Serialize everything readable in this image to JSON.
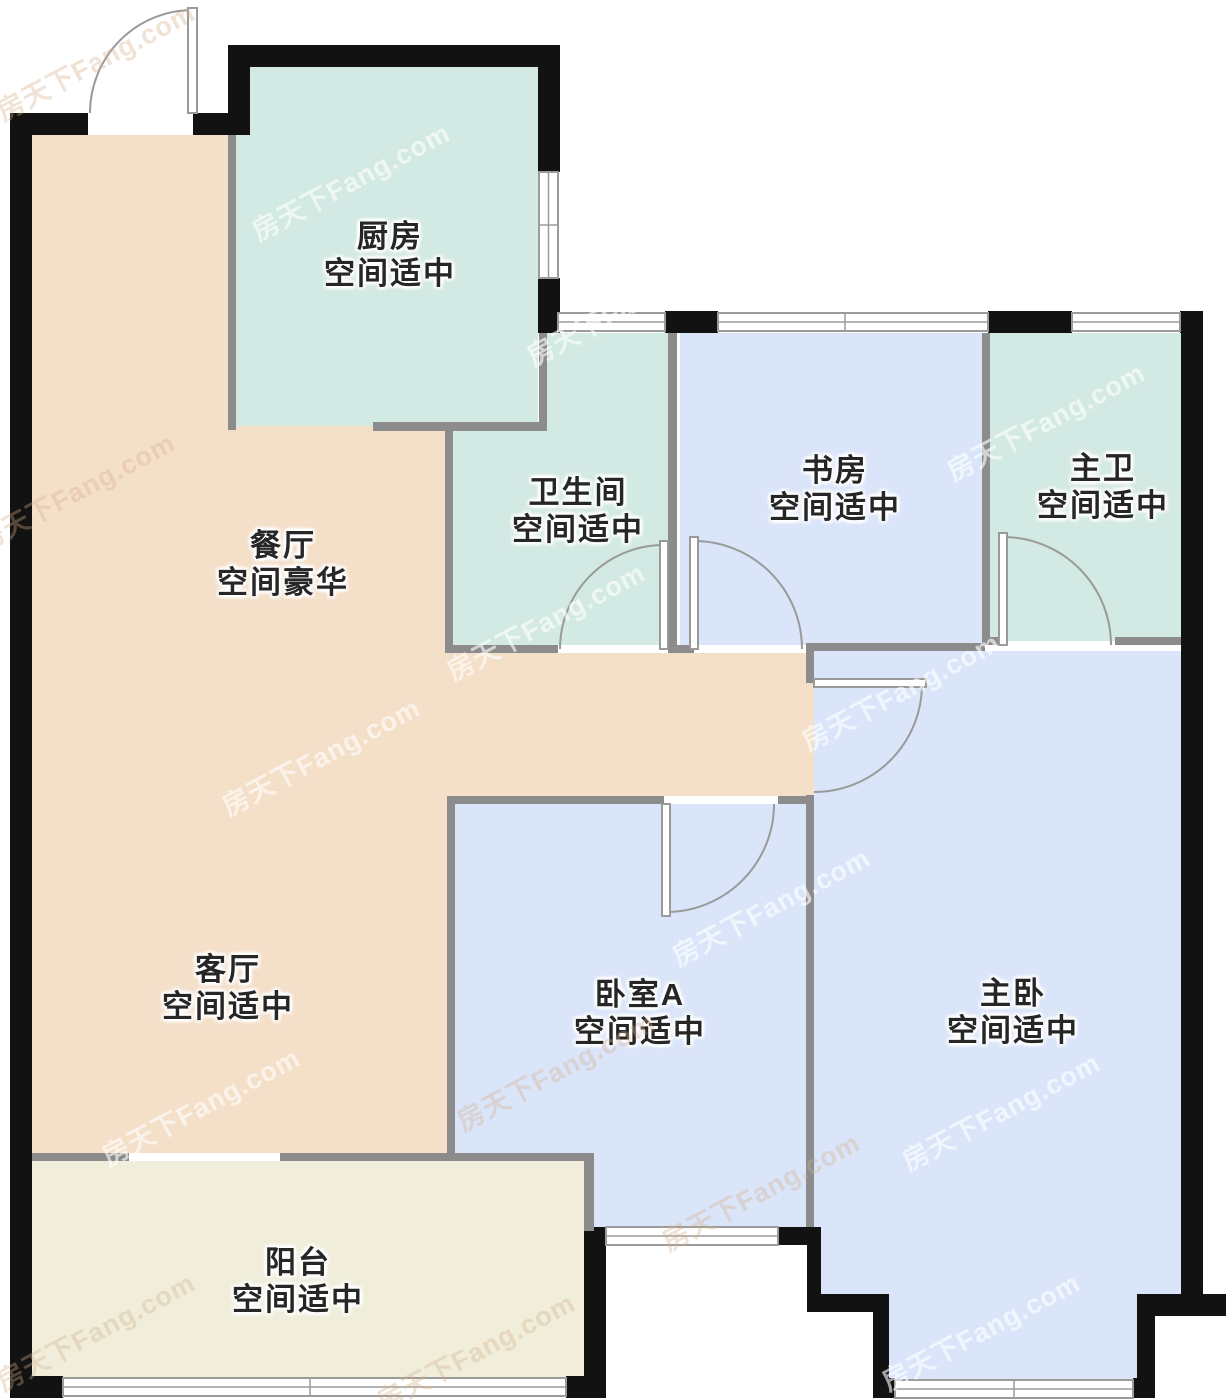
{
  "watermark": "房天下Fang.com",
  "colors": {
    "wall_black": "#121212",
    "wall_gray": "#8c8c8c",
    "room_peach": "#f4dfc9",
    "room_teal": "#d3e9e3",
    "room_blue": "#dae5f9",
    "room_cream": "#f0eeda"
  },
  "rooms": [
    {
      "id": "kitchen",
      "name": "厨房",
      "size_note": "空间适中"
    },
    {
      "id": "bathroom",
      "name": "卫生间",
      "size_note": "空间适中"
    },
    {
      "id": "study",
      "name": "书房",
      "size_note": "空间适中"
    },
    {
      "id": "master-bath",
      "name": "主卫",
      "size_note": "空间适中"
    },
    {
      "id": "dining",
      "name": "餐厅",
      "size_note": "空间豪华"
    },
    {
      "id": "living",
      "name": "客厅",
      "size_note": "空间适中"
    },
    {
      "id": "bedroom-a",
      "name": "卧室A",
      "size_note": "空间适中"
    },
    {
      "id": "master-bedroom",
      "name": "主卧",
      "size_note": "空间适中"
    },
    {
      "id": "balcony",
      "name": "阳台",
      "size_note": "空间适中"
    }
  ]
}
